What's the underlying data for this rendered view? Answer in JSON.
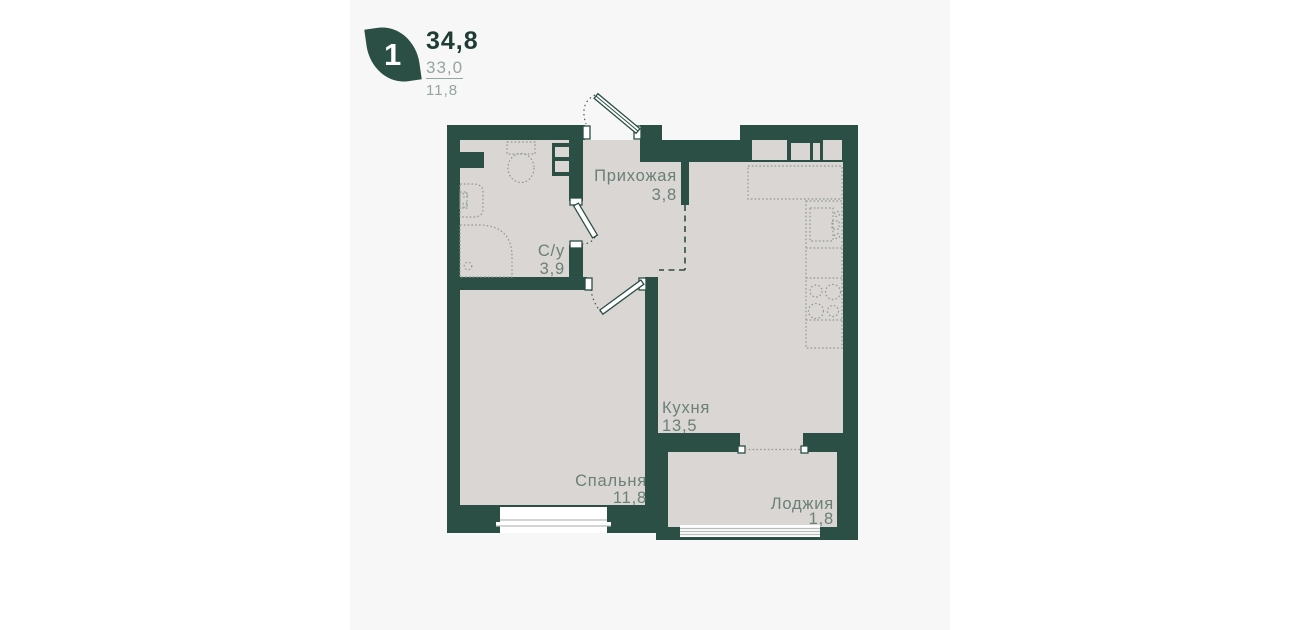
{
  "legend": {
    "badge_number": "1",
    "area_total": "34,8",
    "area_living": "33,0",
    "area_kitchen": "11,8"
  },
  "rooms": [
    {
      "name": "Прихожая",
      "area": "3,8"
    },
    {
      "name": "С/у",
      "area": "3,9"
    },
    {
      "name": "Кухня",
      "area": "13,5"
    },
    {
      "name": "Спальня",
      "area": "11,8"
    },
    {
      "name": "Лоджия",
      "area": "1,8"
    }
  ],
  "colors": {
    "wall": "#2b4f45",
    "floor": "#d9d6d3",
    "panel": "#f7f7f7",
    "page": "#ffffff",
    "fixture_line": "#8f9a94",
    "label_text": "#6a8078"
  }
}
